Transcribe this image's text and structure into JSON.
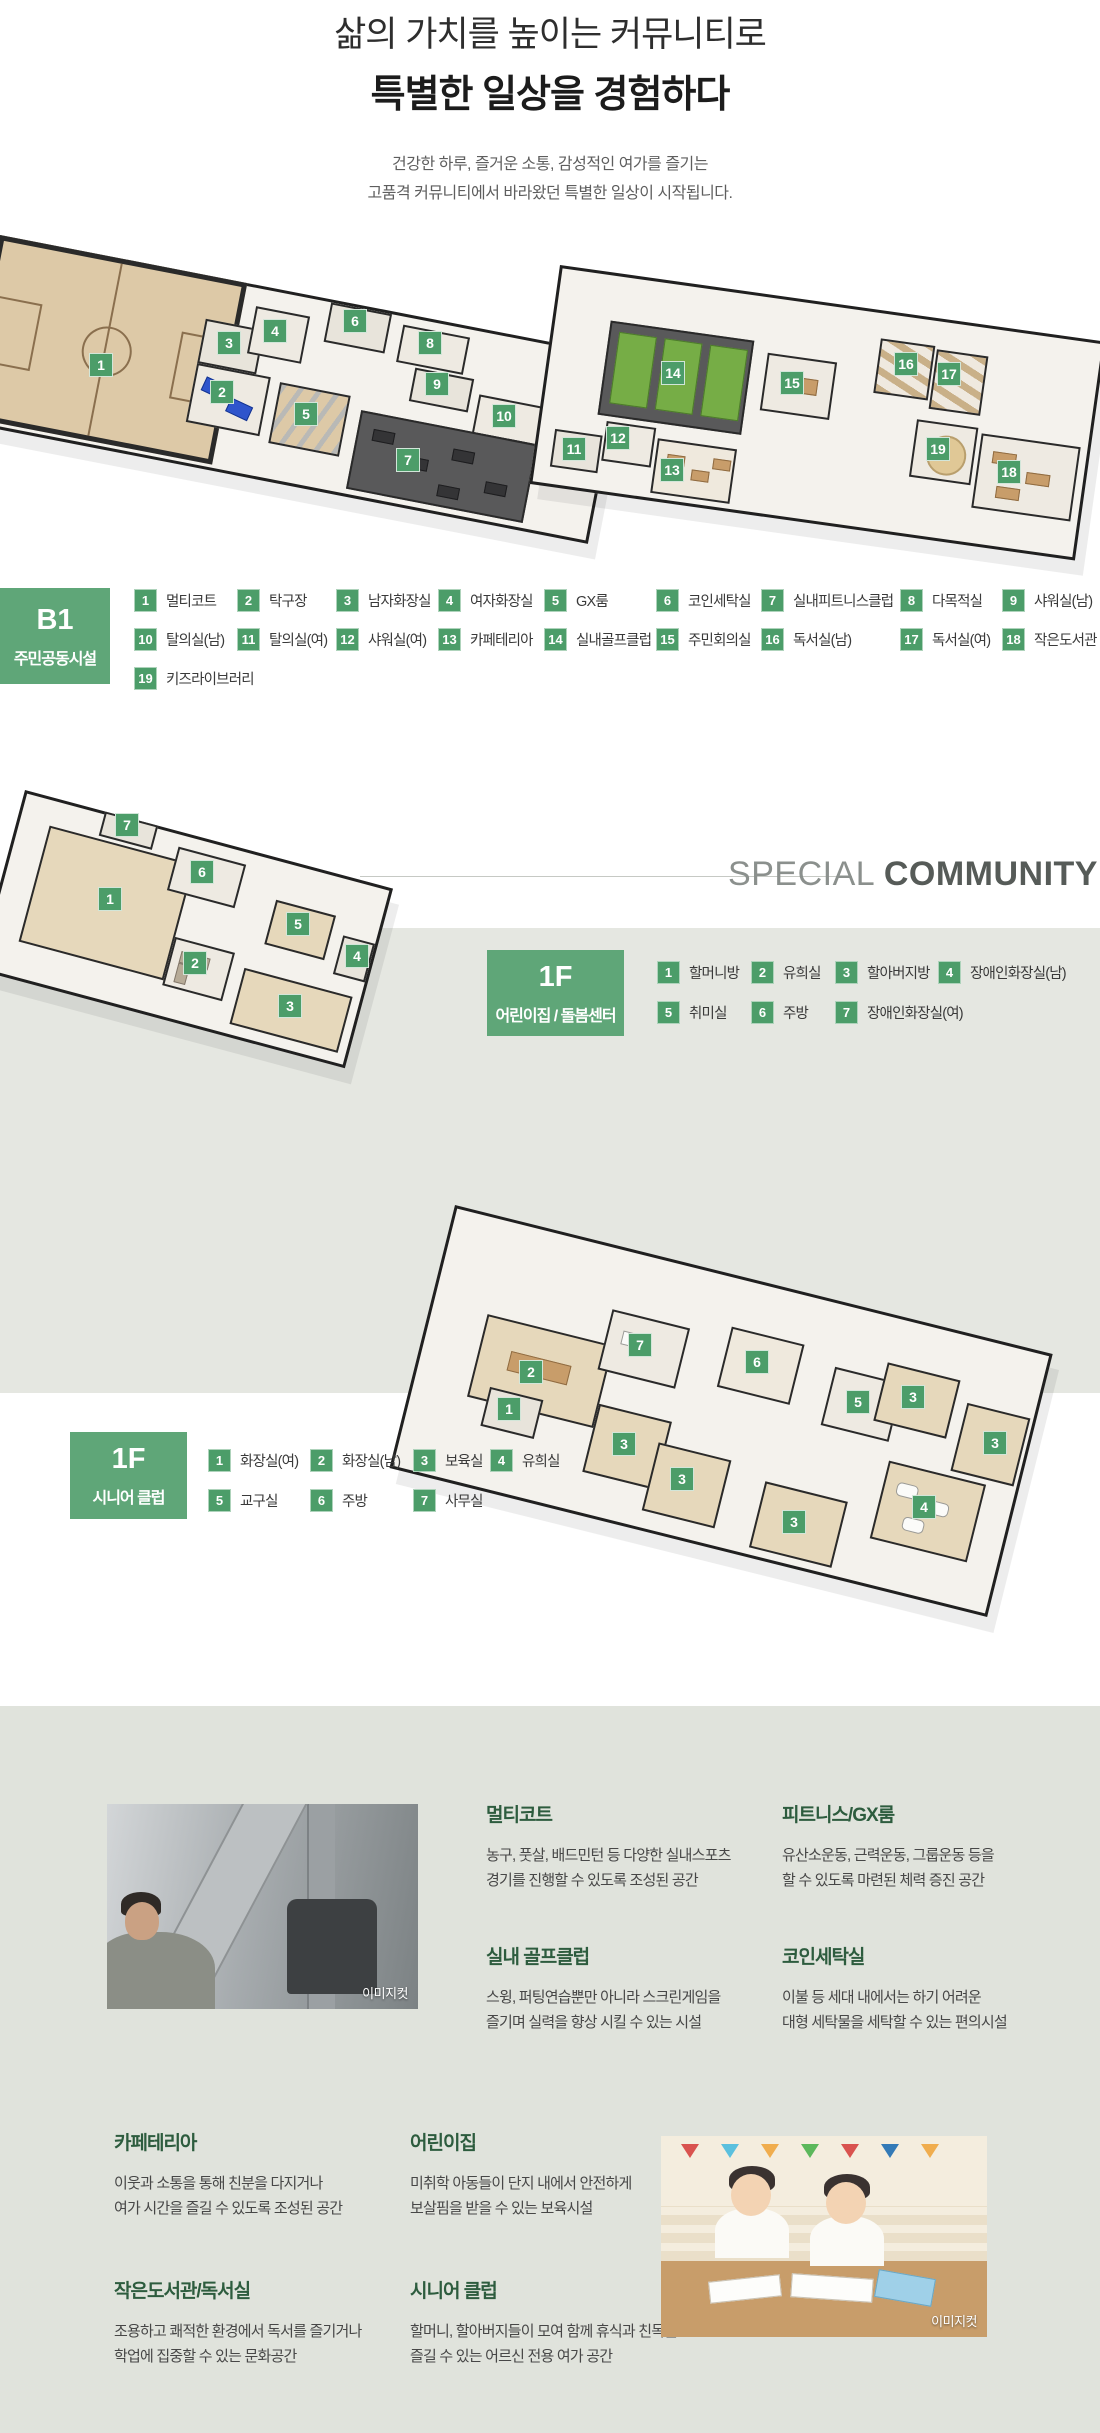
{
  "header": {
    "title_line1": "삶의 가치를 높이는 커뮤니티로",
    "title_line2": "특별한 일상을 경험하다",
    "subtitle_line1": "건강한 하루, 즐거운 소통, 감성적인 여가를 즐기는",
    "subtitle_line2": "고품격 커뮤니티에서 바라왔던 특별한 일상이 시작됩니다."
  },
  "special_community": {
    "light": "SPECIAL",
    "bold": "COMMUNITY"
  },
  "colors": {
    "marker_green": "#4c9d69",
    "floor_box_green": "#5fa678",
    "heading_green": "#2d5c3e",
    "band_mid": "#e5e7e1",
    "band_bottom": "#e0e3dc"
  },
  "sections": {
    "b1": {
      "floor": "B1",
      "name": "주민공동시설",
      "items": [
        {
          "num": "1",
          "label": "멀티코트",
          "x": 134,
          "y": 588
        },
        {
          "num": "2",
          "label": "탁구장",
          "x": 237,
          "y": 588
        },
        {
          "num": "3",
          "label": "남자화장실",
          "x": 336,
          "y": 588
        },
        {
          "num": "4",
          "label": "여자화장실",
          "x": 438,
          "y": 588
        },
        {
          "num": "5",
          "label": "GX룸",
          "x": 544,
          "y": 588
        },
        {
          "num": "6",
          "label": "코인세탁실",
          "x": 656,
          "y": 588
        },
        {
          "num": "7",
          "label": "실내피트니스클럽",
          "x": 761,
          "y": 588
        },
        {
          "num": "8",
          "label": "다목적실",
          "x": 900,
          "y": 588
        },
        {
          "num": "9",
          "label": "샤워실(남)",
          "x": 1002,
          "y": 588
        },
        {
          "num": "10",
          "label": "탈의실(남)",
          "x": 134,
          "y": 627
        },
        {
          "num": "11",
          "label": "탈의실(여)",
          "x": 237,
          "y": 627
        },
        {
          "num": "12",
          "label": "샤워실(여)",
          "x": 336,
          "y": 627
        },
        {
          "num": "13",
          "label": "카페테리아",
          "x": 438,
          "y": 627
        },
        {
          "num": "14",
          "label": "실내골프클럽",
          "x": 544,
          "y": 627
        },
        {
          "num": "15",
          "label": "주민회의실",
          "x": 656,
          "y": 627
        },
        {
          "num": "16",
          "label": "독서실(남)",
          "x": 761,
          "y": 627
        },
        {
          "num": "17",
          "label": "독서실(여)",
          "x": 900,
          "y": 627
        },
        {
          "num": "18",
          "label": "작은도서관",
          "x": 1002,
          "y": 627
        },
        {
          "num": "19",
          "label": "키즈라이브러리",
          "x": 134,
          "y": 666
        }
      ],
      "markers": [
        {
          "n": "1",
          "x": 101,
          "y": 365
        },
        {
          "n": "2",
          "x": 222,
          "y": 392
        },
        {
          "n": "3",
          "x": 229,
          "y": 343
        },
        {
          "n": "4",
          "x": 275,
          "y": 331
        },
        {
          "n": "5",
          "x": 306,
          "y": 414
        },
        {
          "n": "6",
          "x": 355,
          "y": 321
        },
        {
          "n": "7",
          "x": 408,
          "y": 460
        },
        {
          "n": "8",
          "x": 430,
          "y": 343
        },
        {
          "n": "9",
          "x": 437,
          "y": 384
        },
        {
          "n": "10",
          "x": 504,
          "y": 416
        },
        {
          "n": "11",
          "x": 574,
          "y": 449
        },
        {
          "n": "12",
          "x": 618,
          "y": 438
        },
        {
          "n": "13",
          "x": 672,
          "y": 470
        },
        {
          "n": "14",
          "x": 673,
          "y": 373
        },
        {
          "n": "15",
          "x": 792,
          "y": 383
        },
        {
          "n": "16",
          "x": 906,
          "y": 364
        },
        {
          "n": "17",
          "x": 949,
          "y": 374
        },
        {
          "n": "18",
          "x": 1009,
          "y": 472
        },
        {
          "n": "19",
          "x": 938,
          "y": 449
        }
      ]
    },
    "daycare": {
      "floor": "1F",
      "name": "어린이집 / 돌봄센터",
      "items": [
        {
          "num": "1",
          "label": "할머니방",
          "x": 657,
          "y": 960
        },
        {
          "num": "2",
          "label": "유희실",
          "x": 751,
          "y": 960
        },
        {
          "num": "3",
          "label": "할아버지방",
          "x": 835,
          "y": 960
        },
        {
          "num": "4",
          "label": "장애인화장실(남)",
          "x": 938,
          "y": 960
        },
        {
          "num": "5",
          "label": "취미실",
          "x": 657,
          "y": 1000
        },
        {
          "num": "6",
          "label": "주방",
          "x": 751,
          "y": 1000
        },
        {
          "num": "7",
          "label": "장애인화장실(여)",
          "x": 835,
          "y": 1000
        }
      ],
      "markers": [
        {
          "n": "1",
          "x": 110,
          "y": 899
        },
        {
          "n": "2",
          "x": 195,
          "y": 963
        },
        {
          "n": "3",
          "x": 290,
          "y": 1006
        },
        {
          "n": "4",
          "x": 357,
          "y": 956
        },
        {
          "n": "5",
          "x": 298,
          "y": 924
        },
        {
          "n": "6",
          "x": 202,
          "y": 872
        },
        {
          "n": "7",
          "x": 127,
          "y": 825
        }
      ]
    },
    "senior": {
      "floor": "1F",
      "name": "시니어 클럽",
      "items": [
        {
          "num": "1",
          "label": "화장실(여)",
          "x": 208,
          "y": 1448
        },
        {
          "num": "2",
          "label": "화장실(남)",
          "x": 310,
          "y": 1448
        },
        {
          "num": "3",
          "label": "보육실",
          "x": 413,
          "y": 1448
        },
        {
          "num": "4",
          "label": "유희실",
          "x": 490,
          "y": 1448
        },
        {
          "num": "5",
          "label": "교구실",
          "x": 208,
          "y": 1488
        },
        {
          "num": "6",
          "label": "주방",
          "x": 310,
          "y": 1488
        },
        {
          "num": "7",
          "label": "사무실",
          "x": 413,
          "y": 1488
        }
      ],
      "markers": [
        {
          "n": "1",
          "x": 509,
          "y": 1409
        },
        {
          "n": "2",
          "x": 531,
          "y": 1372
        },
        {
          "n": "7",
          "x": 640,
          "y": 1345
        },
        {
          "n": "6",
          "x": 757,
          "y": 1362
        },
        {
          "n": "5",
          "x": 858,
          "y": 1402
        },
        {
          "n": "3",
          "x": 624,
          "y": 1444
        },
        {
          "n": "3",
          "x": 682,
          "y": 1479
        },
        {
          "n": "3",
          "x": 913,
          "y": 1397
        },
        {
          "n": "3",
          "x": 995,
          "y": 1443
        },
        {
          "n": "3",
          "x": 794,
          "y": 1522
        },
        {
          "n": "4",
          "x": 924,
          "y": 1507
        }
      ]
    }
  },
  "descriptions": [
    {
      "title": "멀티코트",
      "line1": "농구, 풋살, 배드민턴 등 다양한 실내스포츠",
      "line2": "경기를 진행할 수 있도록 조성된 공간"
    },
    {
      "title": "피트니스/GX룸",
      "line1": "유산소운동, 근력운동, 그룹운동 등을",
      "line2": "할 수 있도록 마련된 체력 증진 공간"
    },
    {
      "title": "실내 골프클럽",
      "line1": "스윙, 퍼팅연습뿐만 아니라 스크린게임을",
      "line2": "즐기며 실력을 향상 시킬 수 있는 시설"
    },
    {
      "title": "코인세탁실",
      "line1": "이불 등 세대 내에서는 하기 어려운",
      "line2": "대형 세탁물을 세탁할 수 있는 편의시설"
    },
    {
      "title": "카페테리아",
      "line1": "이웃과 소통을 통해 친분을 다지거나",
      "line2": "여가 시간을 즐길 수 있도록 조성된 공간"
    },
    {
      "title": "어린이집",
      "line1": "미취학 아동들이 단지 내에서 안전하게",
      "line2": "보살핌을 받을 수 있는 보육시설"
    },
    {
      "title": "작은도서관/독서실",
      "line1": "조용하고 쾌적한 환경에서 독서를 즐기거나",
      "line2": "학업에 집중할 수 있는 문화공간"
    },
    {
      "title": "시니어 클럽",
      "line1": "할머니, 할아버지들이 모여 함께 휴식과 친목을",
      "line2": "즐길 수 있는 어르신 전용 여가 공간"
    }
  ],
  "photos": {
    "gym_caption": "이미지컷",
    "kids_caption": "이미지컷"
  }
}
